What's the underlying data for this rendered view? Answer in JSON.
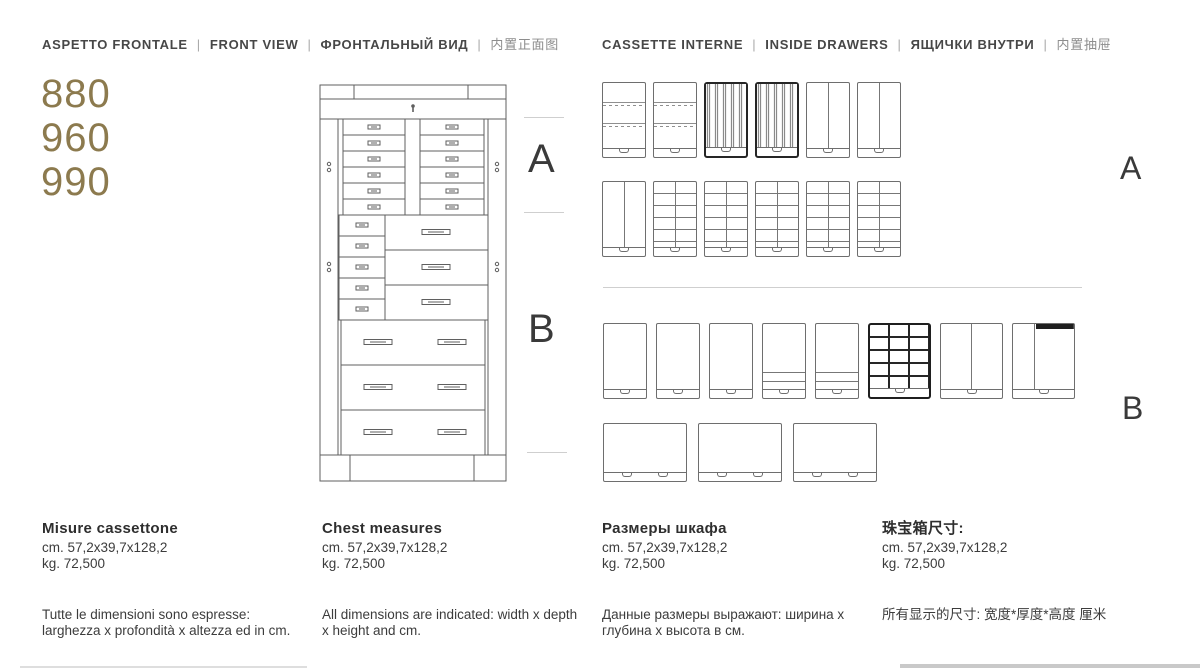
{
  "headers": {
    "sep": "|",
    "left": {
      "segments": [
        "ASPETTO FRONTALE",
        "FRONT VIEW",
        "ФРОНТАЛЬНЫЙ ВИД",
        "内置正面图"
      ]
    },
    "right": {
      "segments": [
        "CASSETTE INTERNE",
        "INSIDE DRAWERS",
        "ЯЩИЧКИ ВНУТРИ",
        "内置抽屉"
      ]
    }
  },
  "models": [
    "880",
    "960",
    "990"
  ],
  "front_view": {
    "label_a": "A",
    "label_b": "B"
  },
  "inside_drawers": {
    "label_a": "A",
    "label_b": "B",
    "row_a1": [
      "ring-slots",
      "ring-slots",
      "watch-rolls",
      "watch-rolls",
      "divider-vertical",
      "divider-vertical"
    ],
    "row_a2": [
      "divider-vertical",
      "grid-2x6",
      "grid-2x6",
      "grid-2x6",
      "grid-2x6",
      "grid-2x6"
    ],
    "row_b1": [
      "plain",
      "plain",
      "plain",
      "tray-lines",
      "tray-lines",
      "grid-dark",
      "divider-vertical-wide",
      "divider-left-top-dark"
    ],
    "row_b2": [
      "plain-wide",
      "plain-wide",
      "plain-wide"
    ]
  },
  "measures": {
    "columns": [
      {
        "title": "Misure cassettone",
        "cm": "cm. 57,2x39,7x128,2",
        "kg": "kg. 72,500",
        "note_lines": [
          "Tutte le dimensioni sono espresse:",
          "larghezza x profondità x altezza ed in cm."
        ]
      },
      {
        "title": "Chest measures",
        "cm": "cm. 57,2x39,7x128,2",
        "kg": "kg. 72,500",
        "note_lines": [
          "All dimensions are indicated: width x depth",
          "x height and cm."
        ]
      },
      {
        "title": "Размеры шкафа",
        "cm": "cm. 57,2x39,7x128,2",
        "kg": "kg. 72,500",
        "note_lines": [
          "Данные размеры выражают: ширина x",
          "глубина x высота в см."
        ]
      },
      {
        "title": "珠宝箱尺寸:",
        "cm": "cm. 57,2x39,7x128,2",
        "kg": "kg. 72,500",
        "note_lines": [
          "所有显示的尺寸: 宽度*厚度*高度  厘米",
          ""
        ]
      }
    ]
  },
  "colors": {
    "accent_gold": "#8c7a4e",
    "ink": "#3b3b3b",
    "drawing_line": "#5f5f5f",
    "rule_light": "#cfcfcf"
  }
}
